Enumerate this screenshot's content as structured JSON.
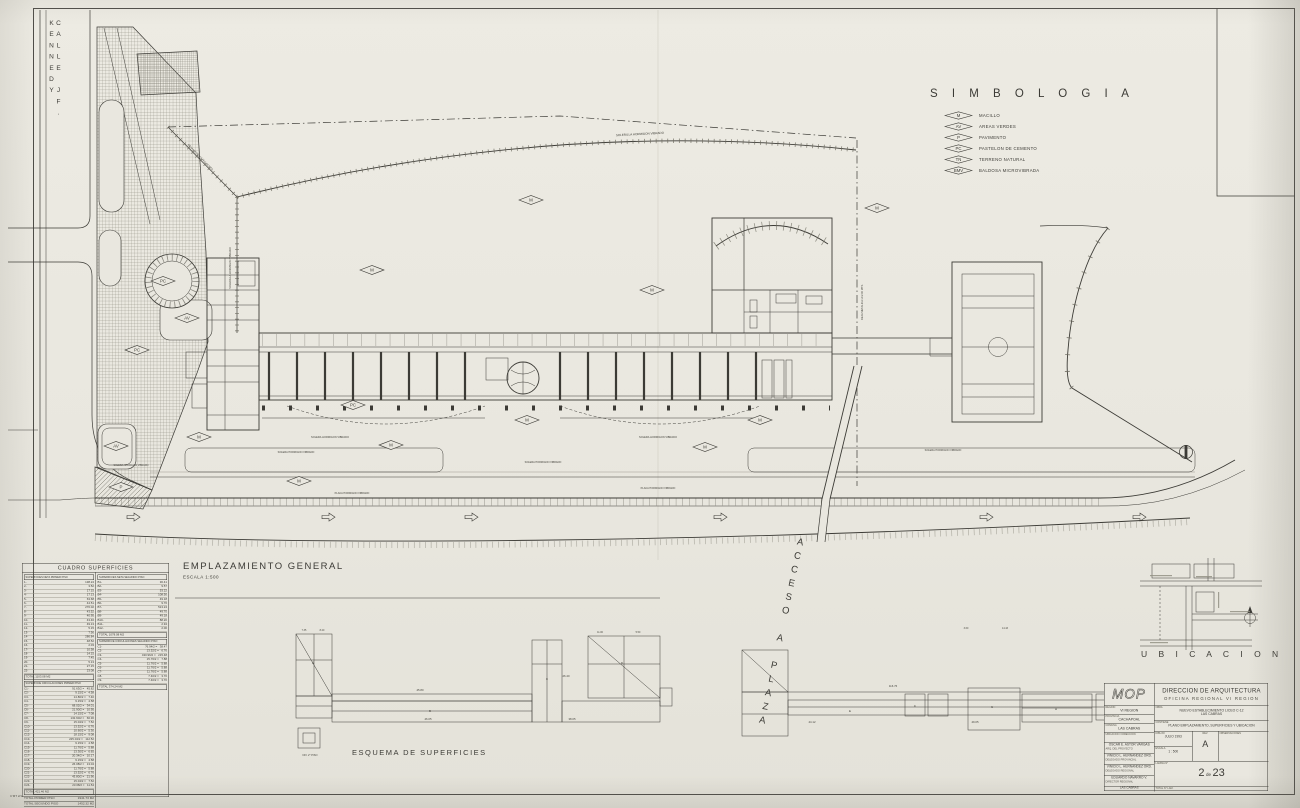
{
  "sheet": {
    "bg": "#e9e7df",
    "ink": "#3c3b36"
  },
  "street": {
    "label": "CALLE JF. KENNEDY"
  },
  "simbologia": {
    "title": "S I M B O L O G I A",
    "items": [
      {
        "code": "M",
        "label": "MACILLO"
      },
      {
        "code": "AV",
        "label": "AREAS VERDES"
      },
      {
        "code": "P",
        "label": "PAVIMENTO"
      },
      {
        "code": "PC",
        "label": "PASTELON DE CEMENTO"
      },
      {
        "code": "TN",
        "label": "TERRENO NATURAL"
      },
      {
        "code": "BMV",
        "label": "BALDOSA MICROVIBRADA"
      }
    ]
  },
  "plan": {
    "title": "EMPLAZAMIENTO  GENERAL",
    "scale": "ESCALA      1:500"
  },
  "esquema": {
    "title": "ESQUEMA  DE  SUPERFICIES"
  },
  "ubicacion": {
    "title": "U B I C A C I O N"
  },
  "acceso": {
    "label": "ACCESO A PLAZA"
  },
  "road": {
    "arrow_xs": [
      127,
      322,
      465,
      714,
      980,
      1133
    ]
  },
  "markers": [
    {
      "x": 163,
      "y": 281,
      "c": "PC"
    },
    {
      "x": 137,
      "y": 350,
      "c": "PC"
    },
    {
      "x": 187,
      "y": 318,
      "c": "AV"
    },
    {
      "x": 116,
      "y": 446,
      "c": "AV"
    },
    {
      "x": 121,
      "y": 487,
      "c": "P"
    },
    {
      "x": 199,
      "y": 437,
      "c": "M"
    },
    {
      "x": 372,
      "y": 270,
      "c": "M"
    },
    {
      "x": 531,
      "y": 200,
      "c": "M"
    },
    {
      "x": 652,
      "y": 290,
      "c": "M"
    },
    {
      "x": 877,
      "y": 208,
      "c": "M"
    },
    {
      "x": 353,
      "y": 405,
      "c": "PC"
    },
    {
      "x": 391,
      "y": 445,
      "c": "M"
    },
    {
      "x": 527,
      "y": 420,
      "c": "M"
    },
    {
      "x": 299,
      "y": 481,
      "c": "M"
    },
    {
      "x": 705,
      "y": 447,
      "c": "M"
    },
    {
      "x": 760,
      "y": 420,
      "c": "M"
    }
  ],
  "annotations": [
    {
      "t": "SOLERILLA HORMIGON VIBRADO",
      "x": 640,
      "y": 135,
      "r": -3,
      "fs": 3
    },
    {
      "t": "SOLERILLA HORMIGON VIBRADO",
      "x": 231,
      "y": 268,
      "r": -90,
      "fs": 2.6
    },
    {
      "t": "REJA METALICA H=2.00 MTS.",
      "x": 863,
      "y": 302,
      "r": -90,
      "fs": 2.6
    },
    {
      "t": "REJA METALICA H=2.00 MTS.",
      "x": 200,
      "y": 158,
      "r": 46,
      "fs": 2.6
    },
    {
      "t": "SOLERA HORMIGON VIBRADO",
      "x": 330,
      "y": 438,
      "r": 0,
      "fs": 2.6
    },
    {
      "t": "SOLERA HORMIGON VIBRADO",
      "x": 658,
      "y": 438,
      "r": 0,
      "fs": 2.6
    },
    {
      "t": "SOLERA HORMIGON VIBRADO",
      "x": 296,
      "y": 453,
      "r": 0,
      "fs": 2.5
    },
    {
      "t": "SOLERA HORMIGON VIBRADO",
      "x": 543,
      "y": 463,
      "r": 0,
      "fs": 2.5
    },
    {
      "t": "SOLERA HORMIGON VIBRADO",
      "x": 943,
      "y": 451,
      "r": 0,
      "fs": 2.5
    },
    {
      "t": "SOLERA HORMIGON VIBRADO",
      "x": 131,
      "y": 466,
      "r": 0,
      "fs": 2.4
    },
    {
      "t": "PLACA HORMIGON VIBRADO",
      "x": 352,
      "y": 494,
      "r": 0,
      "fs": 2.5
    },
    {
      "t": "PLACA HORMIGON VIBRADO",
      "x": 658,
      "y": 489,
      "r": 0,
      "fs": 2.5
    },
    {
      "t": "C'MT 2/1",
      "x": 16,
      "y": 797,
      "r": 0,
      "fs": 3
    },
    {
      "t": "45.80",
      "x": 420,
      "y": 691,
      "r": 0,
      "fs": 2.8
    },
    {
      "t": "46.05",
      "x": 428,
      "y": 720,
      "r": 0,
      "fs": 2.8
    },
    {
      "t": "26.40",
      "x": 566,
      "y": 677,
      "r": 0,
      "fs": 2.8
    },
    {
      "t": "38.05",
      "x": 572,
      "y": 720,
      "r": 0,
      "fs": 2.8
    },
    {
      "t": "116.76",
      "x": 893,
      "y": 687,
      "r": 0,
      "fs": 2.8
    },
    {
      "t": "44.12",
      "x": 812,
      "y": 723,
      "r": 0,
      "fs": 2.8
    },
    {
      "t": "49.05",
      "x": 975,
      "y": 723,
      "r": 0,
      "fs": 2.8
    },
    {
      "t": "7.35",
      "x": 304,
      "y": 631,
      "r": 0,
      "fs": 2.4
    },
    {
      "t": "8.20",
      "x": 322,
      "y": 631,
      "r": 0,
      "fs": 2.4
    },
    {
      "t": "11.00",
      "x": 600,
      "y": 633,
      "r": 0,
      "fs": 2.4
    },
    {
      "t": "5.50",
      "x": 638,
      "y": 633,
      "r": 0,
      "fs": 2.4
    },
    {
      "t": "3.60",
      "x": 966,
      "y": 629,
      "r": 0,
      "fs": 2.4
    },
    {
      "t": "14.43",
      "x": 1005,
      "y": 629,
      "r": 0,
      "fs": 2.4
    },
    {
      "t": "7.70",
      "x": 1106,
      "y": 722,
      "r": 0,
      "fs": 2.4
    },
    {
      "t": "NIV. 2° PISO",
      "x": 310,
      "y": 756,
      "r": 0,
      "fs": 2.6
    },
    {
      "t": "A",
      "x": 313,
      "y": 664,
      "r": 0,
      "fs": 3.2
    },
    {
      "t": "B",
      "x": 430,
      "y": 712,
      "r": 0,
      "fs": 3
    },
    {
      "t": "C",
      "x": 547,
      "y": 680,
      "r": 0,
      "fs": 3
    },
    {
      "t": "D",
      "x": 622,
      "y": 664,
      "r": 0,
      "fs": 3
    },
    {
      "t": "E",
      "x": 850,
      "y": 712,
      "r": 0,
      "fs": 3
    },
    {
      "t": "F",
      "x": 915,
      "y": 707,
      "r": 0,
      "fs": 3
    },
    {
      "t": "G",
      "x": 992,
      "y": 708,
      "r": 0,
      "fs": 3
    },
    {
      "t": "H",
      "x": 1056,
      "y": 710,
      "r": 0,
      "fs": 3
    }
  ],
  "cuadro": {
    "title": "CUADRO  SUPERFICIES",
    "left": {
      "header": "SUPERFICIES  NETA  PRIMER  PISO",
      "rows": [
        [
          "1-",
          "138.24"
        ],
        [
          "2-",
          "3.52"
        ],
        [
          "3-",
          "17.15"
        ],
        [
          "4-",
          "17.13"
        ],
        [
          "5-",
          "63.68"
        ],
        [
          "6-",
          "44.51"
        ],
        [
          "7-",
          "276.02"
        ],
        [
          "8-",
          "43.52"
        ],
        [
          "9-",
          "40.95"
        ],
        [
          "10-",
          "43.46"
        ],
        [
          "11-",
          "49.13"
        ],
        [
          "12-",
          "5.15"
        ],
        [
          "13-",
          "7.56"
        ],
        [
          "14-",
          "286.84"
        ],
        [
          "15-",
          "48.52"
        ],
        [
          "16-",
          "2.03"
        ],
        [
          "17-",
          "10.58"
        ],
        [
          "18-",
          "14.15"
        ],
        [
          "19-",
          "7.45"
        ],
        [
          "20-",
          "5.13"
        ],
        [
          "21-",
          "27.15"
        ],
        [
          "22-",
          "23.08"
        ]
      ],
      "total": "TOTAL   1103.08   M2",
      "header2": "SUPERFICIE  CIRCULACIONES  PRIMER  PISO",
      "rows2": [
        [
          "C1-",
          "91.63/2 =",
          "45.82"
        ],
        [
          "C2-",
          "9.15/2 =",
          "4.58"
        ],
        [
          "C3-",
          "14.80/2 =",
          "7.40"
        ],
        [
          "C4-",
          "9.15/2 =",
          "4.58"
        ],
        [
          "C5-",
          "68.02/2 =",
          "34.01"
        ],
        [
          "C6-",
          "21.90/2 =",
          "10.95"
        ],
        [
          "C7-",
          "14.15/2 =",
          "7.08"
        ],
        [
          "C8-",
          "132.60/2 =",
          "66.30"
        ],
        [
          "C9-",
          "15.04/2 =",
          "7.52"
        ],
        [
          "C10-",
          "13.52/2 =",
          "6.76"
        ],
        [
          "C11-",
          "10.60/2 =",
          "5.30"
        ],
        [
          "C12-",
          "18.15/2 =",
          "9.08"
        ],
        [
          "C13-",
          "225.04/2 =",
          "112.52"
        ],
        [
          "C14-",
          "9.15/2 =",
          "4.58"
        ],
        [
          "C15-",
          "11.76/2 =",
          "5.88"
        ],
        [
          "C16-",
          "13.30/2 =",
          "6.65"
        ],
        [
          "C17-",
          "20.34/2 =",
          "10.17"
        ],
        [
          "C18-",
          "9.15/2 =",
          "4.58"
        ],
        [
          "C19-",
          "26.08/2 =",
          "13.04"
        ],
        [
          "C20-",
          "11.76/2 =",
          "5.88"
        ],
        [
          "C21-",
          "13.52/2 =",
          "6.76"
        ],
        [
          "C22-",
          "43.80/2 =",
          "21.90"
        ],
        [
          "C23-",
          "15.04/2 =",
          "7.52"
        ],
        [
          "C24-",
          "23.08/2 =",
          "11.54"
        ]
      ],
      "total2": "TOTAL          421.46   M2",
      "grand": [
        [
          "TOTAL  PRIMER  PISO",
          "1941.73  M2"
        ],
        [
          "TOTAL  SEGUNDO  PISO",
          "1452.32  M2"
        ],
        [
          "TOTAL  PROYECTADO",
          "3394.05  M2"
        ]
      ]
    },
    "right": {
      "header": "SUPERFICIES  NETA  SEGUNDO  PISO",
      "rows": [
        [
          "B1-",
          "30.41"
        ],
        [
          "B2-",
          "9.57"
        ],
        [
          "B3-",
          "53.22"
        ],
        [
          "B4-",
          "108.50"
        ],
        [
          "B5-",
          "49.18"
        ],
        [
          "B6-",
          "9.76"
        ],
        [
          "B7-",
          "513.24"
        ],
        [
          "B8-",
          "49.70"
        ],
        [
          "B9-",
          "49.18"
        ],
        [
          "B10-",
          "88.20"
        ],
        [
          "B11-",
          "2.94"
        ],
        [
          "B12-",
          "2.00"
        ]
      ],
      "total": "TOTAL   1078.08   M2",
      "header2": "SUPERFICIE  CIRCULACIONES  SEGUNDO  PISO",
      "rows2": [
        [
          "C1-",
          "76.94/2 =",
          "38.47"
        ],
        [
          "C2-",
          "13.52/2 =",
          "6.76"
        ],
        [
          "C3-",
          "430.96/2 =",
          "215.48"
        ],
        [
          "C4-",
          "15.76/2 =",
          "7.88"
        ],
        [
          "C5-",
          "11.76/2 =",
          "5.88"
        ],
        [
          "C6-",
          "11.76/2 =",
          "5.88"
        ],
        [
          "C7-",
          "11.76/2 =",
          "5.88"
        ],
        [
          "C8-",
          "7.40/2 =",
          "3.70"
        ],
        [
          "C9-",
          "7.40/2 =",
          "3.70"
        ]
      ],
      "total2": "TOTAL          374.24   M2"
    }
  },
  "titleblock": {
    "logo": "MOP",
    "org": "DIRECCION  DE  ARQUITECTURA",
    "office": "OFICINA    REGIONAL    VI  REGION",
    "fields": {
      "region_label": "REGION",
      "region": "VI  REGION",
      "provincia_label": "PROVINCIA",
      "provincia": "CACHAPOAL",
      "comuna_label": "COMUNA",
      "comuna": "LAS  CABRAS",
      "ubicacion_label": "UBICACION / DIRECCION",
      "obra_label": "OBRA",
      "obra1": "NUEVO ESTABLECIMIENTO LICEO C-12",
      "obra2": "LAS CABRAS",
      "contiene_label": "CONTIENE",
      "contiene": "PLANO EMPLAZAMIENTO, SUPERFICIES Y UBICACION",
      "dibujo_label": "DIBUJO",
      "dibujo": "JULIO  1993",
      "escala_label": "ESCALA",
      "escala": "1 : 500",
      "rev_label": "REV.",
      "rev": "A",
      "obs_label": "OBSERVACIONES",
      "lamina_label": "LAMINA N°",
      "sheet_num": "2",
      "sheet_sep": "de",
      "sheet_total": "23",
      "total_lam_label": "TOTAL N° LAM.",
      "footer": "LAS  CABRAS"
    },
    "names": [
      {
        "name": "OSCAR E. ASTOR VARGAS",
        "role": "ARQ.  DEL  PROYECTO"
      },
      {
        "name": "VINICIO L. HERNANDEZ ORD.",
        "role": "DELEGADO  PROVINCIAL"
      },
      {
        "name": "VINICIO L. HERNANDEZ ORD.",
        "role": "DELEGADO  REGIONAL"
      },
      {
        "name": "EDUARDO NAVARRO V.",
        "role": "DIRECTOR  REGIONAL"
      }
    ]
  }
}
